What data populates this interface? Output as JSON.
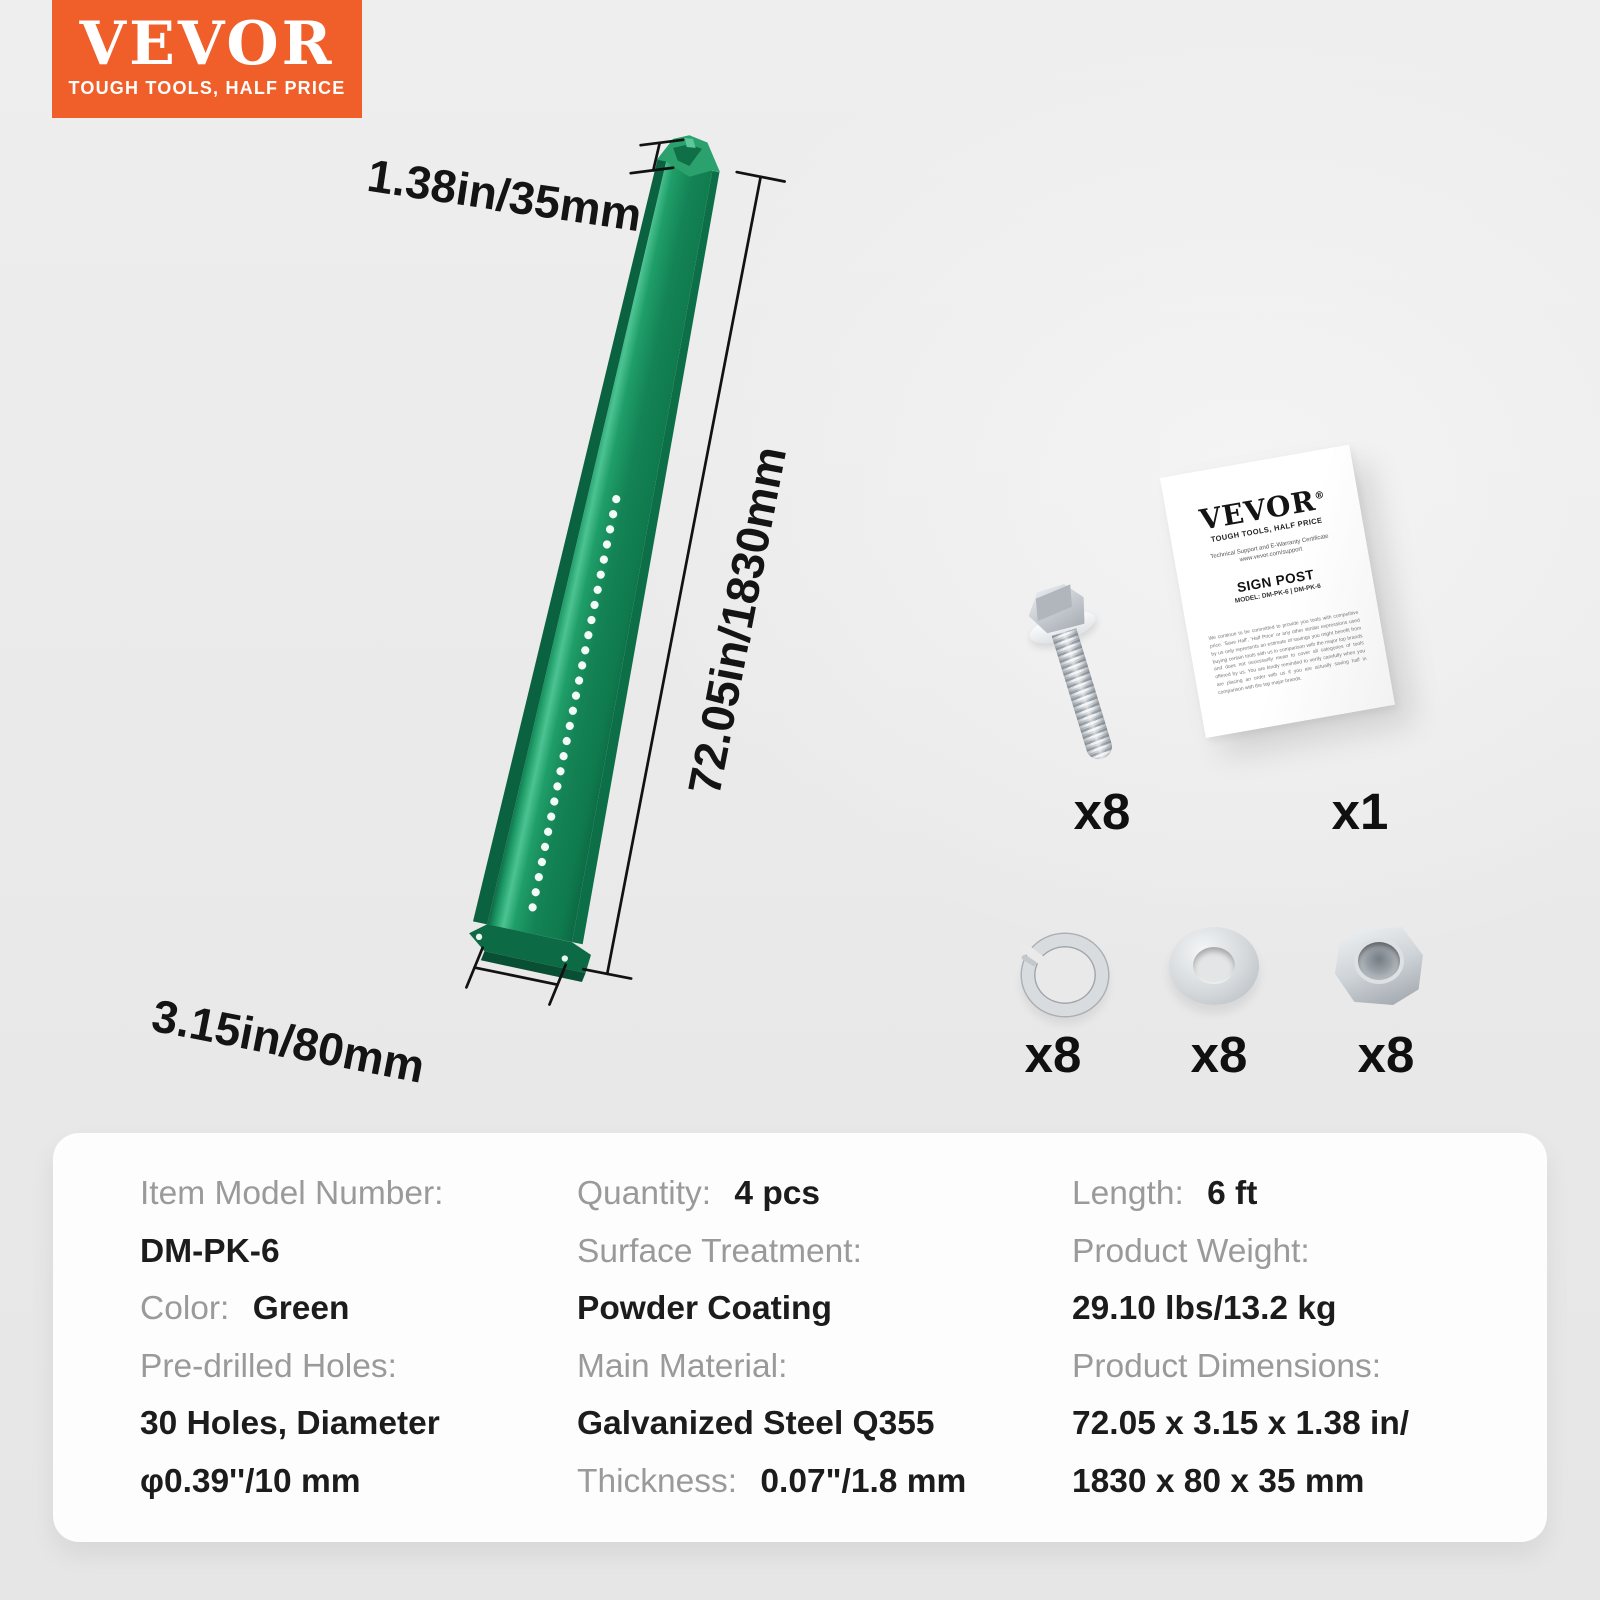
{
  "logo": {
    "brand": "VEVOR",
    "tagline": "TOUGH TOOLS, HALF PRICE"
  },
  "colors": {
    "brand_orange": "#F05F2A",
    "post_green": "#178A58",
    "page_background": "#EBEBEB",
    "panel_background": "#FDFDFD",
    "label_gray": "#9A9A9A",
    "value_black": "#1C1C1C"
  },
  "diagram": {
    "top_width": "1.38in/35mm",
    "length": "72.05in/1830mm",
    "bottom_width": "3.15in/80mm"
  },
  "kit": {
    "bolt_qty": "x8",
    "manual_qty": "x1",
    "spring_washer_qty": "x8",
    "flat_washer_qty": "x8",
    "hex_nut_qty": "x8",
    "manual": {
      "brand": "VEVOR",
      "reg": "®",
      "tagline": "TOUGH TOOLS, HALF PRICE",
      "support_line": "Technical Support and E-Warranty Certificate",
      "website": "www.vevor.com/support",
      "doc_title": "SIGN POST",
      "model_line": "MODEL: DM-PK-6 | DM-PK-6",
      "disclaimer": "We continue to be committed to provide you tools with competitive price. 'Save Half', 'Half Price' or any other similar expressions used by us only represents an estimate of savings you might benefit from buying certain tools with us in comparison with the major top brands and does not necessarily mean to cover all categories of tools offered by us. You are kindly reminded to verify carefully when you are placing an order with us if you are actually saving half in comparison with the top major brands."
    }
  },
  "specs": {
    "col1": {
      "r1_label": "Item Model Number:",
      "r2_value": "DM-PK-6",
      "r3_label": "Color:",
      "r3_value": "Green",
      "r4_label": "Pre-drilled Holes:",
      "r5_value": "30 Holes, Diameter",
      "r6_value": "φ0.39''/10 mm"
    },
    "col2": {
      "r1_label": "Quantity:",
      "r1_value": "4 pcs",
      "r2_label": "Surface Treatment:",
      "r3_value": "Powder Coating",
      "r4_label": "Main Material:",
      "r5_value": "Galvanized Steel Q355",
      "r6_label": "Thickness:",
      "r6_value": "0.07\"/1.8 mm"
    },
    "col3": {
      "r1_label": "Length:",
      "r1_value": "6 ft",
      "r2_label": "Product Weight:",
      "r3_value": "29.10 lbs/13.2 kg",
      "r4_label": "Product Dimensions:",
      "r5_value": "72.05 x 3.15 x 1.38  in/",
      "r6_value": "1830 x 80 x 35 mm"
    }
  }
}
